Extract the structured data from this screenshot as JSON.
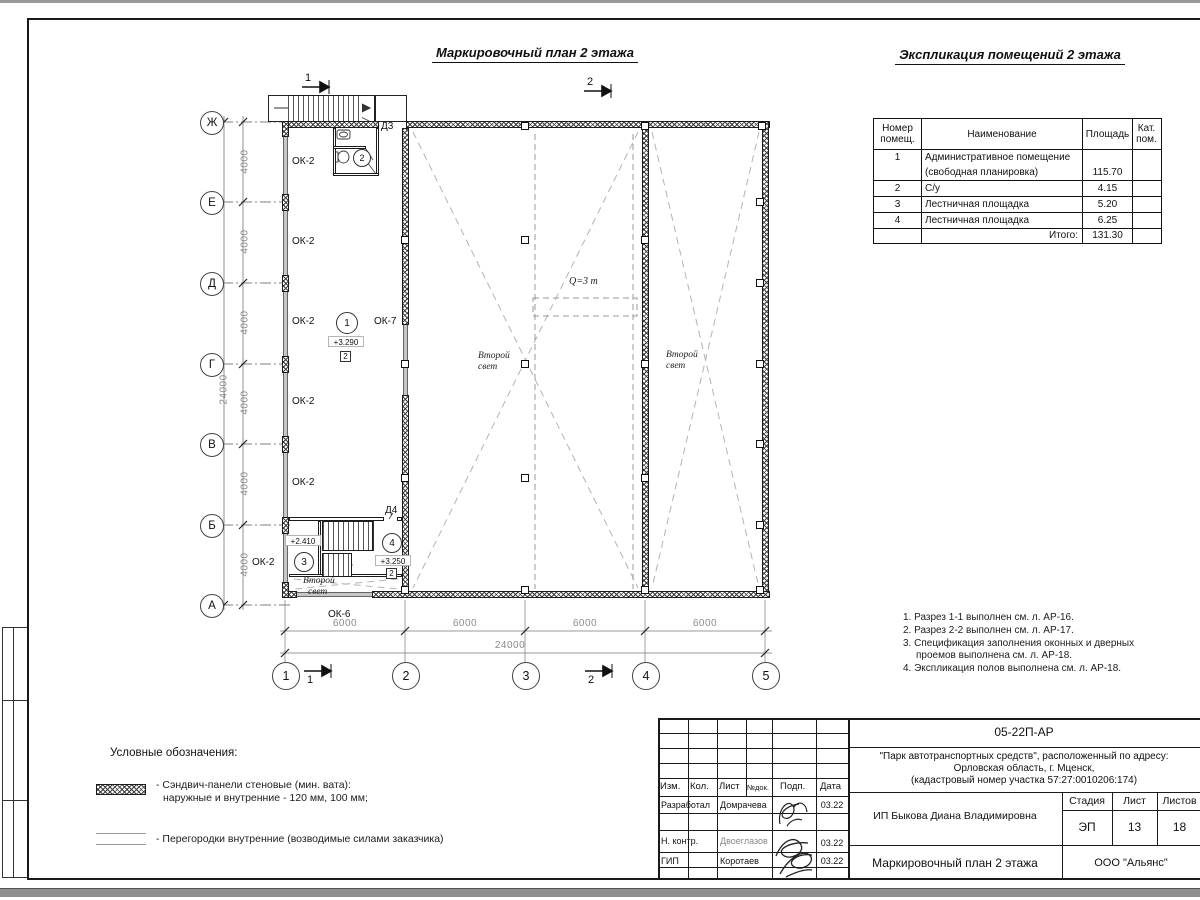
{
  "sheet": {
    "plan_title": "Маркировочный план 2 этажа",
    "expl_title": "Экспликация помещений 2 этажа"
  },
  "axes": {
    "rows": [
      "Ж",
      "Е",
      "Д",
      "Г",
      "В",
      "Б",
      "А"
    ],
    "cols": [
      "1",
      "2",
      "3",
      "4",
      "5"
    ],
    "dim4000": "4000",
    "dim6000": "6000",
    "total_v": "24000",
    "total_h": "24000"
  },
  "plan": {
    "ok2": "ОК-2",
    "ok7": "ОК-7",
    "ok6": "ОК-6",
    "d3": "Д3",
    "d4": "Д4",
    "room1": "1",
    "room2": "2",
    "room3": "3",
    "room4": "4",
    "lvl1": "+3.290",
    "lvl3": "+2.410",
    "lvl4": "+3.250",
    "floor_tag": "2",
    "sl1": "Второй",
    "sl2": "свет",
    "crane": "Q=3 т",
    "sec1": "1",
    "sec2": "2"
  },
  "expl": {
    "h_num1": "Номер",
    "h_num2": "помещ.",
    "h_name": "Наименование",
    "h_area": "Площадь",
    "h_cat1": "Кат.",
    "h_cat2": "пом.",
    "rows": [
      {
        "num": "1",
        "name": "Административное помещение",
        "area": "",
        "cat": ""
      },
      {
        "num": "",
        "name": "(свободная планировка)",
        "area": "115.70",
        "cat": ""
      },
      {
        "num": "2",
        "name": "С/у",
        "area": "4.15",
        "cat": ""
      },
      {
        "num": "3",
        "name": "Лестничная площадка",
        "area": "5.20",
        "cat": ""
      },
      {
        "num": "4",
        "name": "Лестничная площадка",
        "area": "6.25",
        "cat": ""
      }
    ],
    "total_label": "Итого:",
    "total_value": "131.30"
  },
  "notes": {
    "n1": "1. Разрез 1-1 выполнен см. л. АР-16.",
    "n2": "2. Разрез 2-2 выполнен см. л. АР-17.",
    "n3a": "3. Спецификация заполнения оконных и дверных",
    "n3b": "проемов выполнена см. л. АР-18.",
    "n4": "4. Экспликация полов выполнена см. л. АР-18."
  },
  "legend": {
    "title": "Условные обозначения:",
    "i1a": "- Сэндвич-панели стеновые (мин. вата):",
    "i1b": "наружные и внутренние - 120 мм, 100 мм;",
    "i2": "- Перегородки внутренние (возводимые силами заказчика)"
  },
  "tb": {
    "code": "05-22П-АР",
    "project_l1": "\"Парк автотранспортных средств\",  расположенный по адресу:",
    "project_l2": "Орловская область, г. Мценск,",
    "project_l3": "(кадастровый номер участка 57:27:0010206:174)",
    "client": "ИП Быкова Диана Владимировна",
    "stage_label": "Стадия",
    "sheet_label": "Лист",
    "sheets_label": "Листов",
    "stage": "ЭП",
    "sheet_num": "13",
    "sheets_total": "18",
    "drawing_title": "Маркировочный план 2 этажа",
    "company": "ООО \"Альянс\"",
    "h_izm": "Изм.",
    "h_kol": "Кол.",
    "h_list": "Лист",
    "h_doc": "№док.",
    "h_sign": "Подп.",
    "h_date": "Дата",
    "r1_role": "Разработал",
    "r1_name": "Домрачева",
    "r1_date": "03.22",
    "r2_role": "Н. контр.",
    "r2_name": "Двоеглазов",
    "r2_date": "03.22",
    "r3_role": "ГИП",
    "r3_name": "Коротаев",
    "r3_date": "03.22"
  }
}
